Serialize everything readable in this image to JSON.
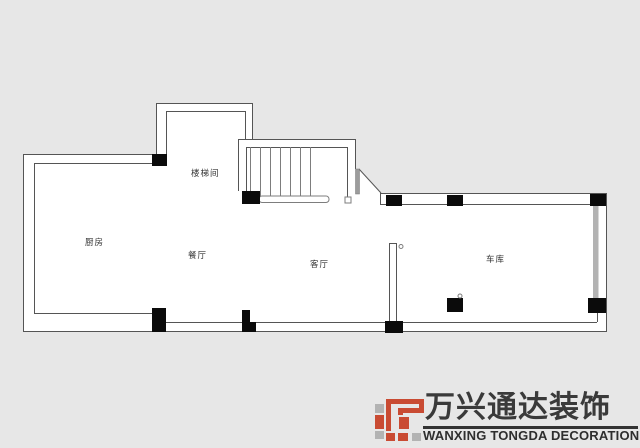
{
  "canvas": {
    "width": 640,
    "height": 448
  },
  "plan": {
    "type": "floor-plan",
    "rooms": [
      {
        "id": "kitchen",
        "label": "厨房"
      },
      {
        "id": "dining",
        "label": "餐厅"
      },
      {
        "id": "living",
        "label": "客厅"
      },
      {
        "id": "garage",
        "label": "车库"
      },
      {
        "id": "stairwell",
        "label": "楼梯间"
      }
    ]
  },
  "logo": {
    "company_cn": "万兴通达装饰",
    "company_en": "WANXING TONGDA DECORATION"
  },
  "colors": {
    "background": "#e7e7e7",
    "plan_fill": "#ffffff",
    "wall_line": "#555555",
    "thin_line": "#7d7d7d",
    "column_fill": "#0b0b0b",
    "door_gray": "#9c9c9c",
    "garage_door_gray": "#b3b3b3",
    "brand_red": "#c94b33",
    "brand_gray": "#b3b3b3",
    "logo_text": "#3a3a3a"
  }
}
